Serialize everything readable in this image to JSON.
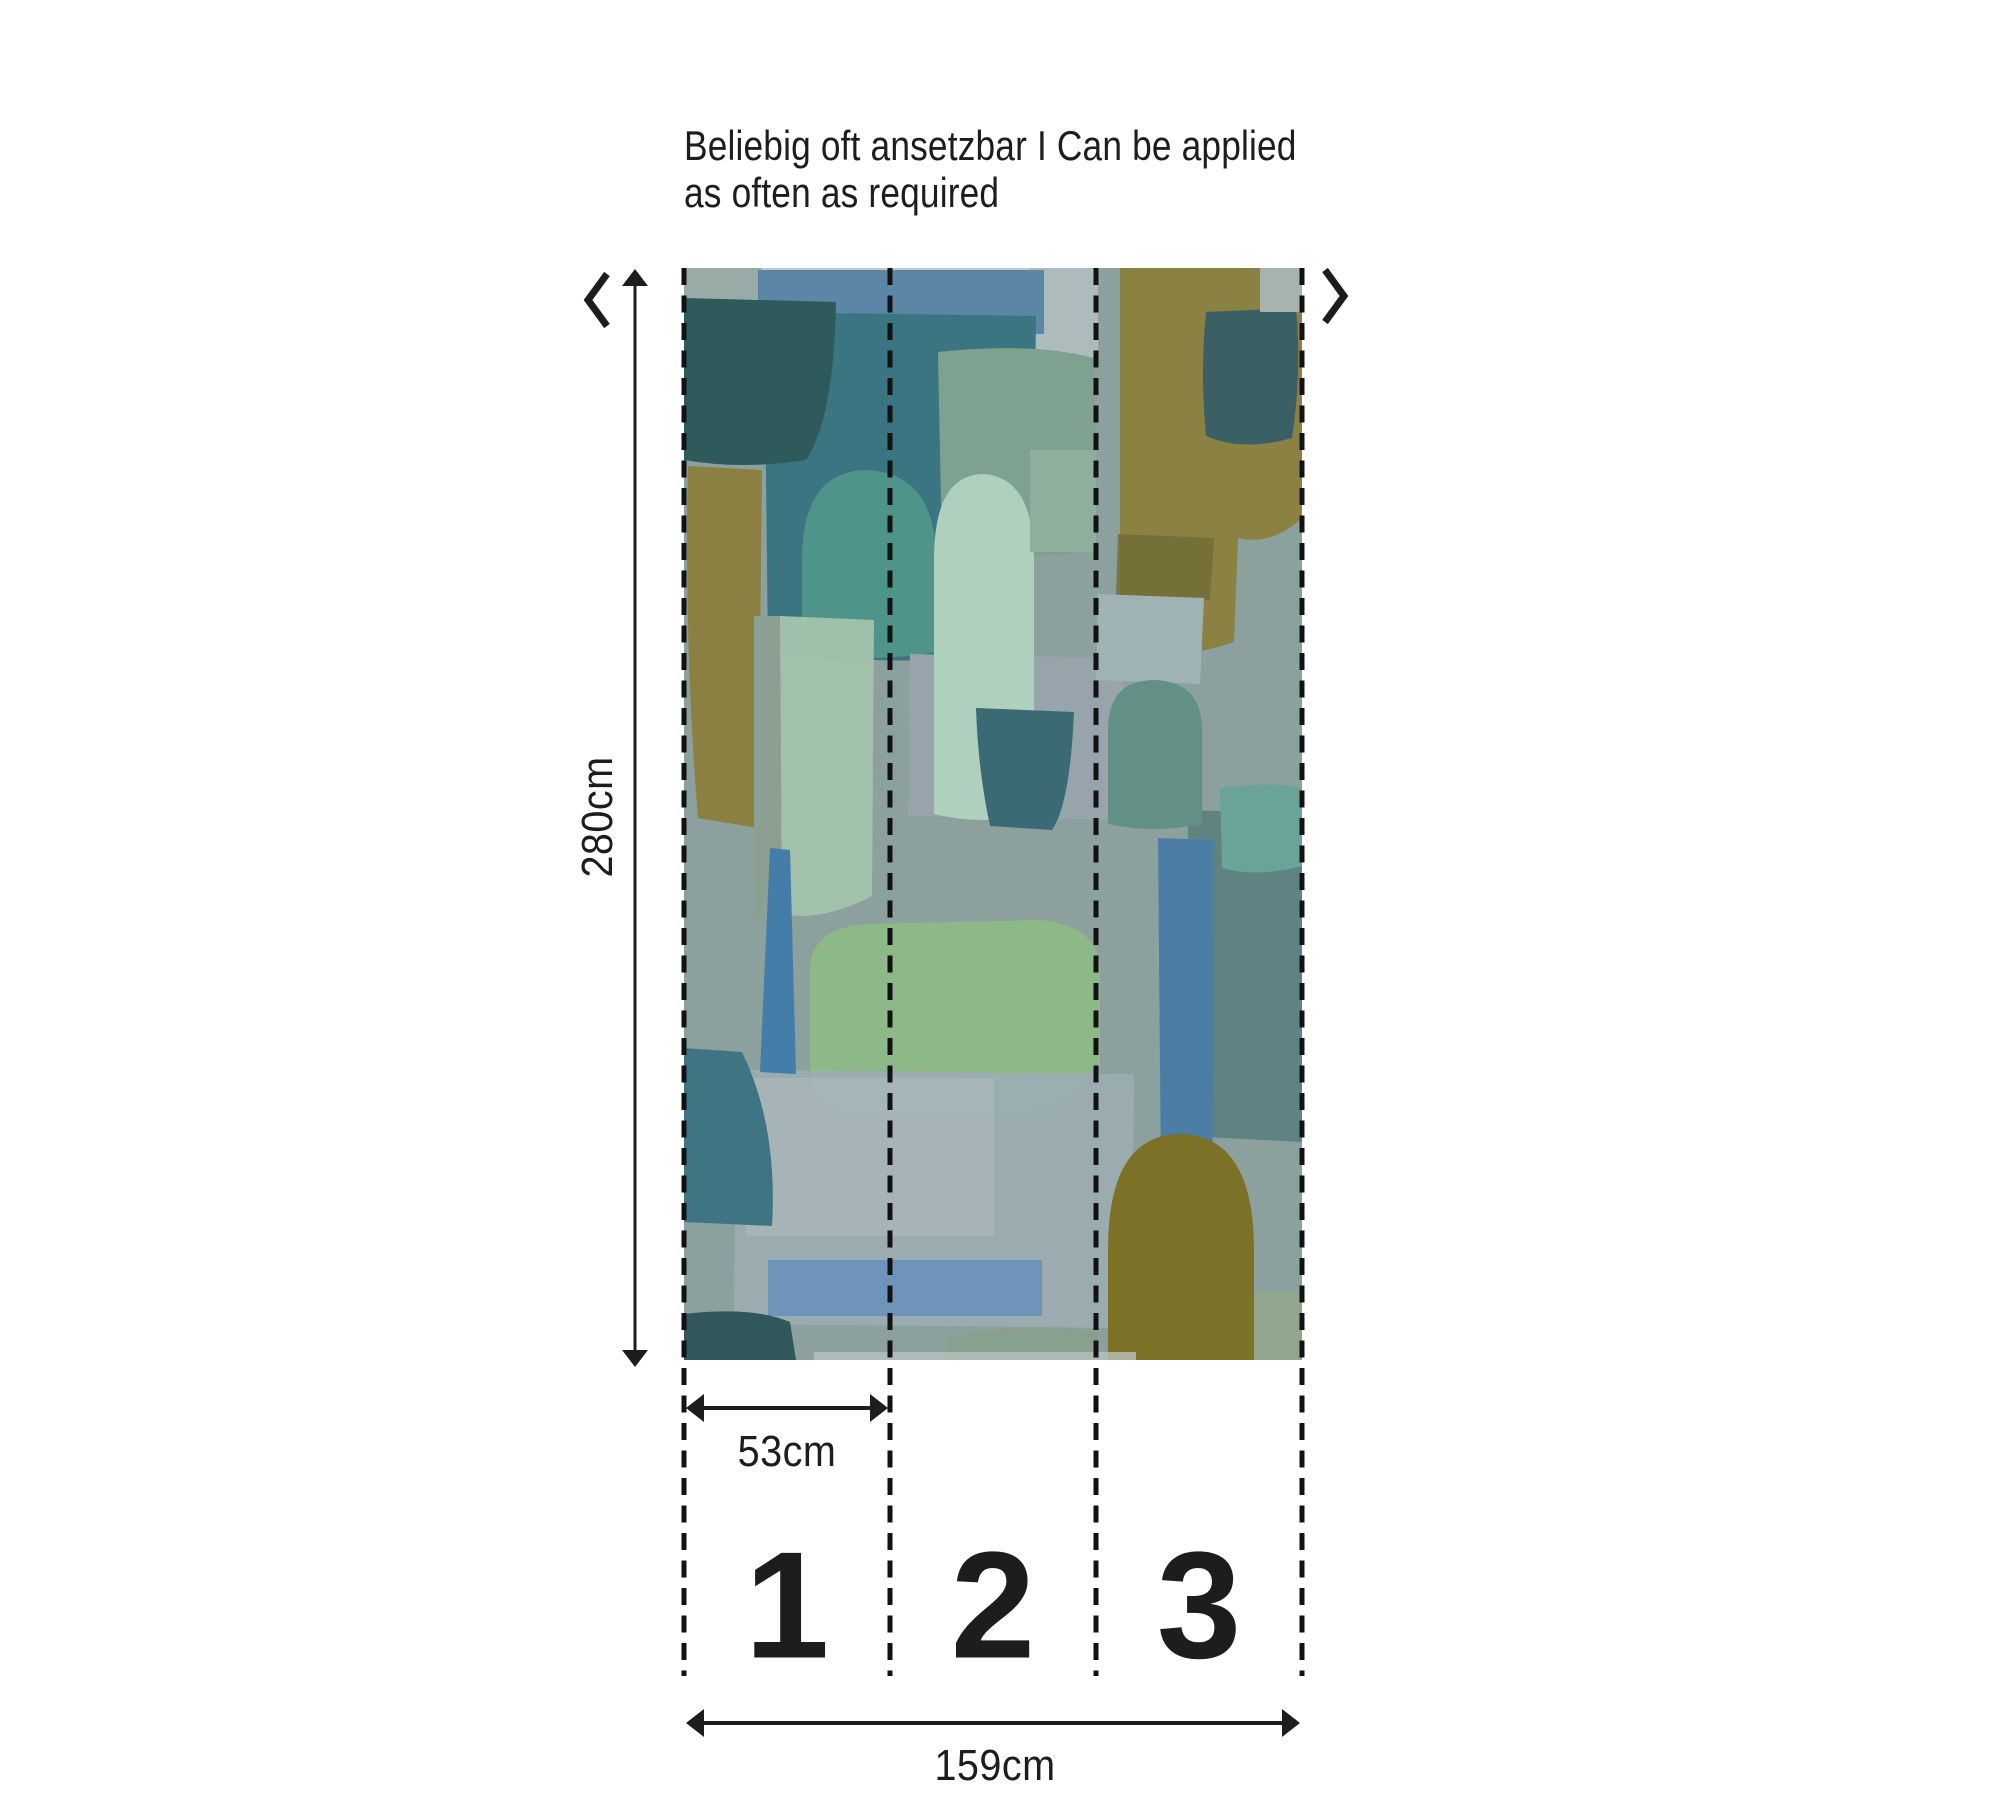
{
  "note": {
    "line1": "Beliebig oft ansetzbar I Can be applied",
    "line2": "as often as required"
  },
  "repeat_indicators": {
    "left_icon": "chevron-left-icon",
    "right_icon": "chevron-right-icon"
  },
  "dimensions": {
    "height": "280cm",
    "panel_width": "53cm",
    "total_width": "159cm"
  },
  "panels": [
    {
      "number": "1"
    },
    {
      "number": "2"
    },
    {
      "number": "3"
    }
  ],
  "colors": {
    "ink": "#1d1d1b",
    "background": "#ffffff",
    "wallpaper_base": "#8ca09e",
    "wallpaper_palette": [
      "#5b86a6",
      "#2e5a5c",
      "#3b7581",
      "#7fa290",
      "#8b8142",
      "#6f6c34",
      "#3a6066",
      "#8b7f42",
      "#4f948b",
      "#98a4ac",
      "#a3c3ab",
      "#afd0bc",
      "#3a6b74",
      "#9fb3b4",
      "#8fae9c",
      "#5f8283",
      "#639086",
      "#6aa398",
      "#8cb987",
      "#9cadb2",
      "#6e94ba",
      "#447da7",
      "#3f7483",
      "#4b7da5",
      "#7b7227",
      "#31565c",
      "#87a18e",
      "#92a68e",
      "#c5cdd0"
    ]
  },
  "wallpaper": {
    "base": "#8ca09e",
    "shapes": [
      {
        "t": "r",
        "x": 0,
        "y": 0,
        "w": 618,
        "h": 1092,
        "f": "#8ca09e"
      },
      {
        "t": "r",
        "x": 28,
        "y": 0,
        "w": 362,
        "h": 16,
        "f": "#c5cdd0",
        "o": 0.9
      },
      {
        "t": "r",
        "x": 0,
        "y": 0,
        "w": 78,
        "h": 44,
        "f": "#9aaaa6"
      },
      {
        "t": "r",
        "x": 346,
        "y": 0,
        "w": 68,
        "h": 92,
        "f": "#aebbbc"
      },
      {
        "t": "r",
        "x": 74,
        "y": 2,
        "w": 286,
        "h": 64,
        "f": "#5b86a6"
      },
      {
        "t": "p",
        "d": "M80,44 L352,48 L348,384 Q210,402 84,382 Z",
        "f": "#3b7581"
      },
      {
        "t": "p",
        "d": "M0,30 L152,34 Q150,150 122,192 Q58,202 0,192 Z",
        "f": "#2e5a5c"
      },
      {
        "t": "p",
        "d": "M254,84 Q350,74 410,90 L414,282 Q326,294 258,284 Z",
        "f": "#7fa290"
      },
      {
        "t": "p",
        "d": "M436,0 L618,0 L618,250 Q588,278 554,270 L550,374 Q472,400 436,372 Z",
        "f": "#8b8142"
      },
      {
        "t": "p",
        "d": "M434,266 L530,270 L526,332 L432,328 Z",
        "f": "#6f6c34",
        "o": 0.8
      },
      {
        "t": "p",
        "d": "M522,44 L612,40 Q618,104 608,170 Q558,184 522,168 Q516,104 522,44 Z",
        "f": "#3a6066"
      },
      {
        "t": "r",
        "x": 576,
        "y": 0,
        "w": 42,
        "h": 44,
        "f": "#a7b4ae"
      },
      {
        "t": "p",
        "d": "M4,198 L78,202 L74,560 L14,550 Q0,380 4,198 Z",
        "f": "#8b7f42"
      },
      {
        "t": "r",
        "x": 70,
        "y": 348,
        "w": 28,
        "h": 302,
        "f": "#8ba093"
      },
      {
        "t": "p",
        "d": "M118,384 L118,292 Q118,202 184,202 Q252,206 252,292 L252,384 Q184,396 118,384 Z",
        "f": "#4f948b"
      },
      {
        "t": "p",
        "d": "M226,386 L440,390 L438,552 L224,548 Z",
        "f": "#98a4ac"
      },
      {
        "t": "p",
        "d": "M96,348 L190,352 L188,628 Q138,654 98,646 Z",
        "f": "#a3c3ab",
        "o": 0.95
      },
      {
        "t": "p",
        "d": "M250,546 L250,292 Q250,206 300,206 Q350,210 350,292 L350,546 Q298,558 250,546 Z",
        "f": "#afd0bc"
      },
      {
        "t": "p",
        "d": "M292,440 L390,444 Q386,536 368,562 L306,558 Q294,502 292,440 Z",
        "f": "#3a6b74"
      },
      {
        "t": "p",
        "d": "M414,326 L520,330 L516,416 L412,412 Z",
        "f": "#9fb3b4"
      },
      {
        "t": "r",
        "x": 346,
        "y": 182,
        "w": 66,
        "h": 102,
        "f": "#8fae9c"
      },
      {
        "t": "p",
        "d": "M504,542 L618,546 L618,874 L502,868 Z",
        "f": "#5f8283"
      },
      {
        "t": "p",
        "d": "M424,556 L424,462 Q424,412 471,412 Q518,414 518,462 L518,556 Q470,566 424,556 Z",
        "f": "#639086"
      },
      {
        "t": "p",
        "d": "M536,520 Q606,512 618,522 L618,598 Q572,610 538,600 Z",
        "f": "#6aa398"
      },
      {
        "t": "p",
        "d": "M126,700 Q128,660 182,656 L356,652 Q414,658 416,700 L416,798 Q378,848 310,848 L168,844 Q128,838 126,798 Z",
        "f": "#8cb987"
      },
      {
        "t": "p",
        "d": "M52,802 L450,806 L448,1060 L50,1056 Z",
        "f": "#9cadb2",
        "o": 0.95
      },
      {
        "t": "r",
        "x": 62,
        "y": 810,
        "w": 248,
        "h": 158,
        "f": "#aebcbd",
        "o": 0.55
      },
      {
        "t": "p",
        "d": "M86,580 L106,582 L112,806 L76,804 Z",
        "f": "#447da7"
      },
      {
        "t": "p",
        "d": "M0,780 L58,784 Q94,858 88,958 L0,954 Z",
        "f": "#3f7483"
      },
      {
        "t": "r",
        "x": 84,
        "y": 992,
        "w": 274,
        "h": 56,
        "f": "#6e94ba"
      },
      {
        "t": "p",
        "d": "M474,570 L530,572 L528,1032 L478,1030 Z",
        "f": "#4b7da5"
      },
      {
        "t": "p",
        "d": "M424,1092 L424,982 Q424,866 497,866 Q570,868 570,982 L570,1092 Z",
        "f": "#7b7227"
      },
      {
        "t": "p",
        "d": "M0,1046 Q68,1038 106,1054 L112,1092 L0,1092 Z",
        "f": "#31565c"
      },
      {
        "t": "p",
        "d": "M262,1092 L262,1070 Q330,1054 414,1064 L414,1092 Z",
        "f": "#87a18e"
      },
      {
        "t": "r",
        "x": 570,
        "y": 1024,
        "w": 48,
        "h": 68,
        "f": "#92a68e"
      },
      {
        "t": "r",
        "x": 130,
        "y": 1084,
        "w": 322,
        "h": 8,
        "f": "#b9c0bf",
        "o": 0.8
      }
    ]
  }
}
